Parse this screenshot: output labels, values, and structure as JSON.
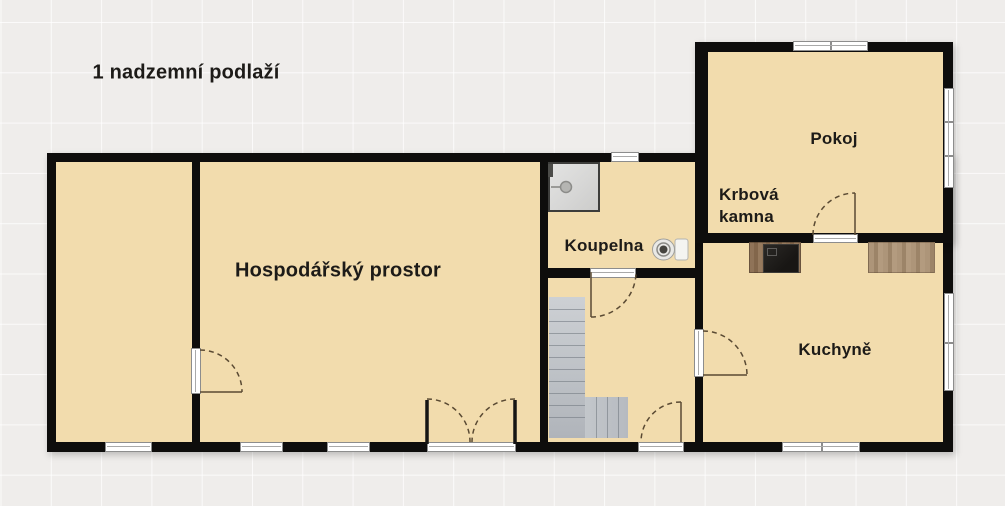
{
  "title": "1 nadzemní podlaží",
  "rooms": {
    "hospodarsky": {
      "label": "Hospodářský prostor"
    },
    "koupelna": {
      "label": "Koupelna"
    },
    "pokoj": {
      "label": "Pokoj"
    },
    "kuchyne": {
      "label": "Kuchyně"
    },
    "side_room": {
      "label": ""
    },
    "hallway": {
      "label": ""
    }
  },
  "annotations": {
    "krbova_kamna": {
      "label": "Krbová kamna"
    }
  },
  "fixtures": {
    "shower": "shower-icon",
    "toilet": "toilet-icon",
    "staircase": "staircase-icon",
    "stove": "stove-counter-icon",
    "counter": "kitchen-counter-icon"
  },
  "colors": {
    "wall": "#0e0d0c",
    "floor": "#f2dcad",
    "background": "#efedeb",
    "door_arc": "#5a4a33",
    "stairs": "#bcc0c5",
    "shower": "#d7d7d6",
    "window": "#ffffff"
  }
}
